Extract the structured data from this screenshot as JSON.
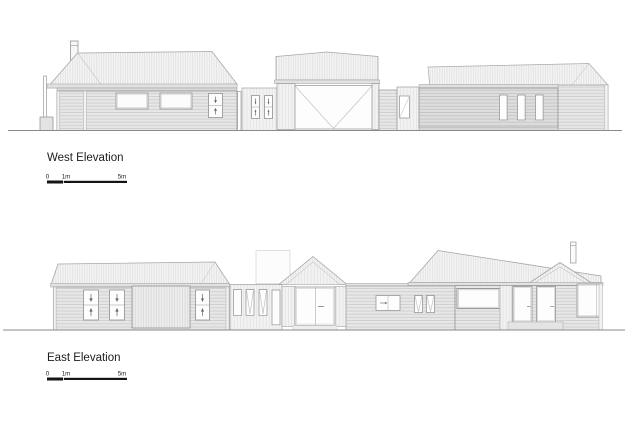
{
  "page": {
    "background_color": "#ffffff"
  },
  "colors": {
    "line_gray": "#999999",
    "roof_hatch": "#d8d8d8",
    "cladding_fill": "#e7e7e7",
    "text": "#1c1c1c",
    "scale_bar": "#141414"
  },
  "drawings": [
    {
      "id": "west-elevation",
      "title": "West Elevation",
      "scale_bar": {
        "labels": [
          "0",
          "1m",
          "5m"
        ]
      }
    },
    {
      "id": "east-elevation",
      "title": "East Elevation",
      "scale_bar": {
        "labels": [
          "0",
          "1m",
          "5m"
        ]
      }
    }
  ]
}
